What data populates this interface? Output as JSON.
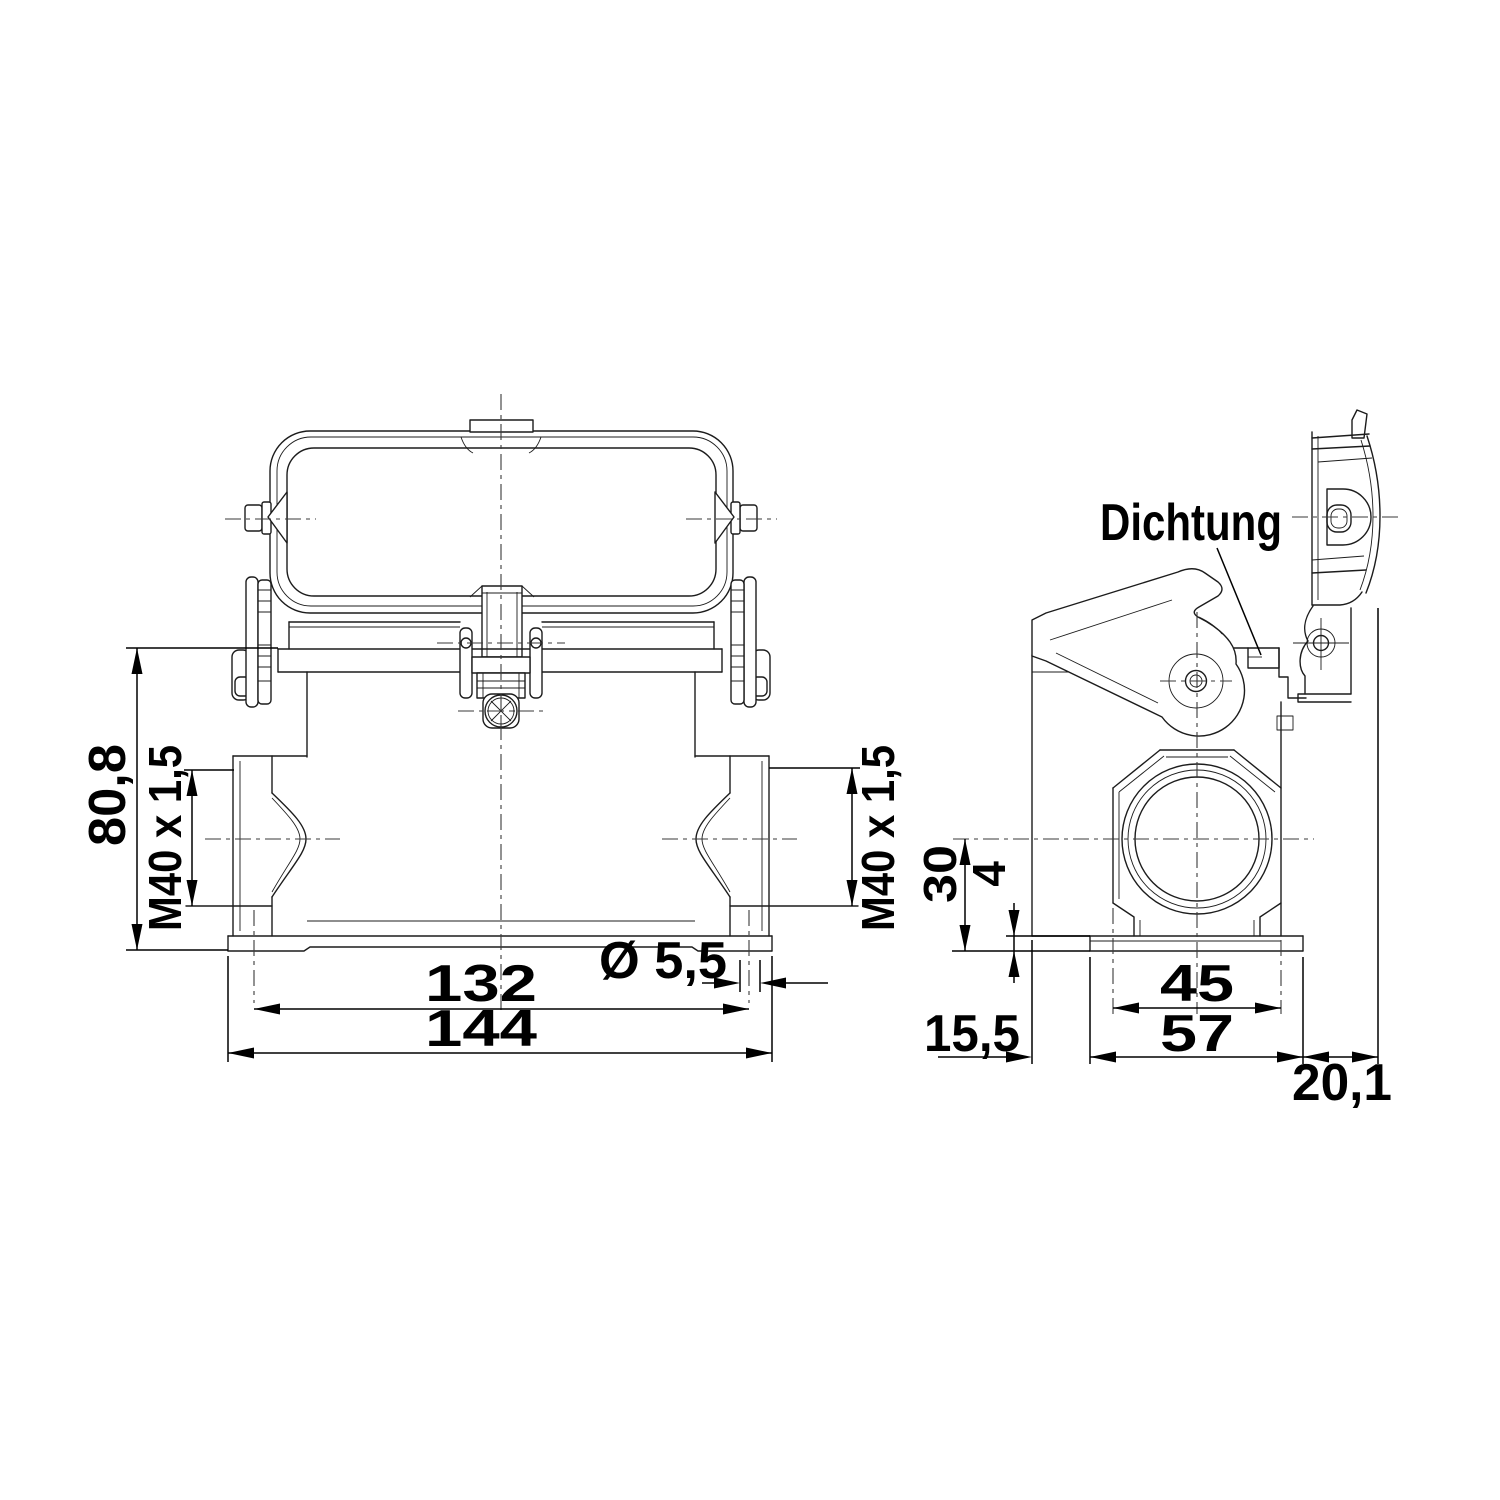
{
  "drawing": {
    "colors": {
      "background": "#ffffff",
      "lines": "#1c1c1c",
      "dimensions": "#000000"
    },
    "front_view": {
      "dims": {
        "overall_height": "80,8",
        "thread_left": "M40 x 1,5",
        "thread_right": "M40 x 1,5",
        "hole_pitch": "132",
        "overall_width": "144",
        "hole_diameter": "Ø 5,5"
      }
    },
    "side_view": {
      "dims": {
        "entry_center_height": "30",
        "base_plate_thickness": "4",
        "boss_width": "45",
        "base_depth": "57",
        "front_offset": "15,5",
        "cover_projection": "20,1"
      },
      "labels": {
        "seal": "Dichtung"
      }
    }
  }
}
